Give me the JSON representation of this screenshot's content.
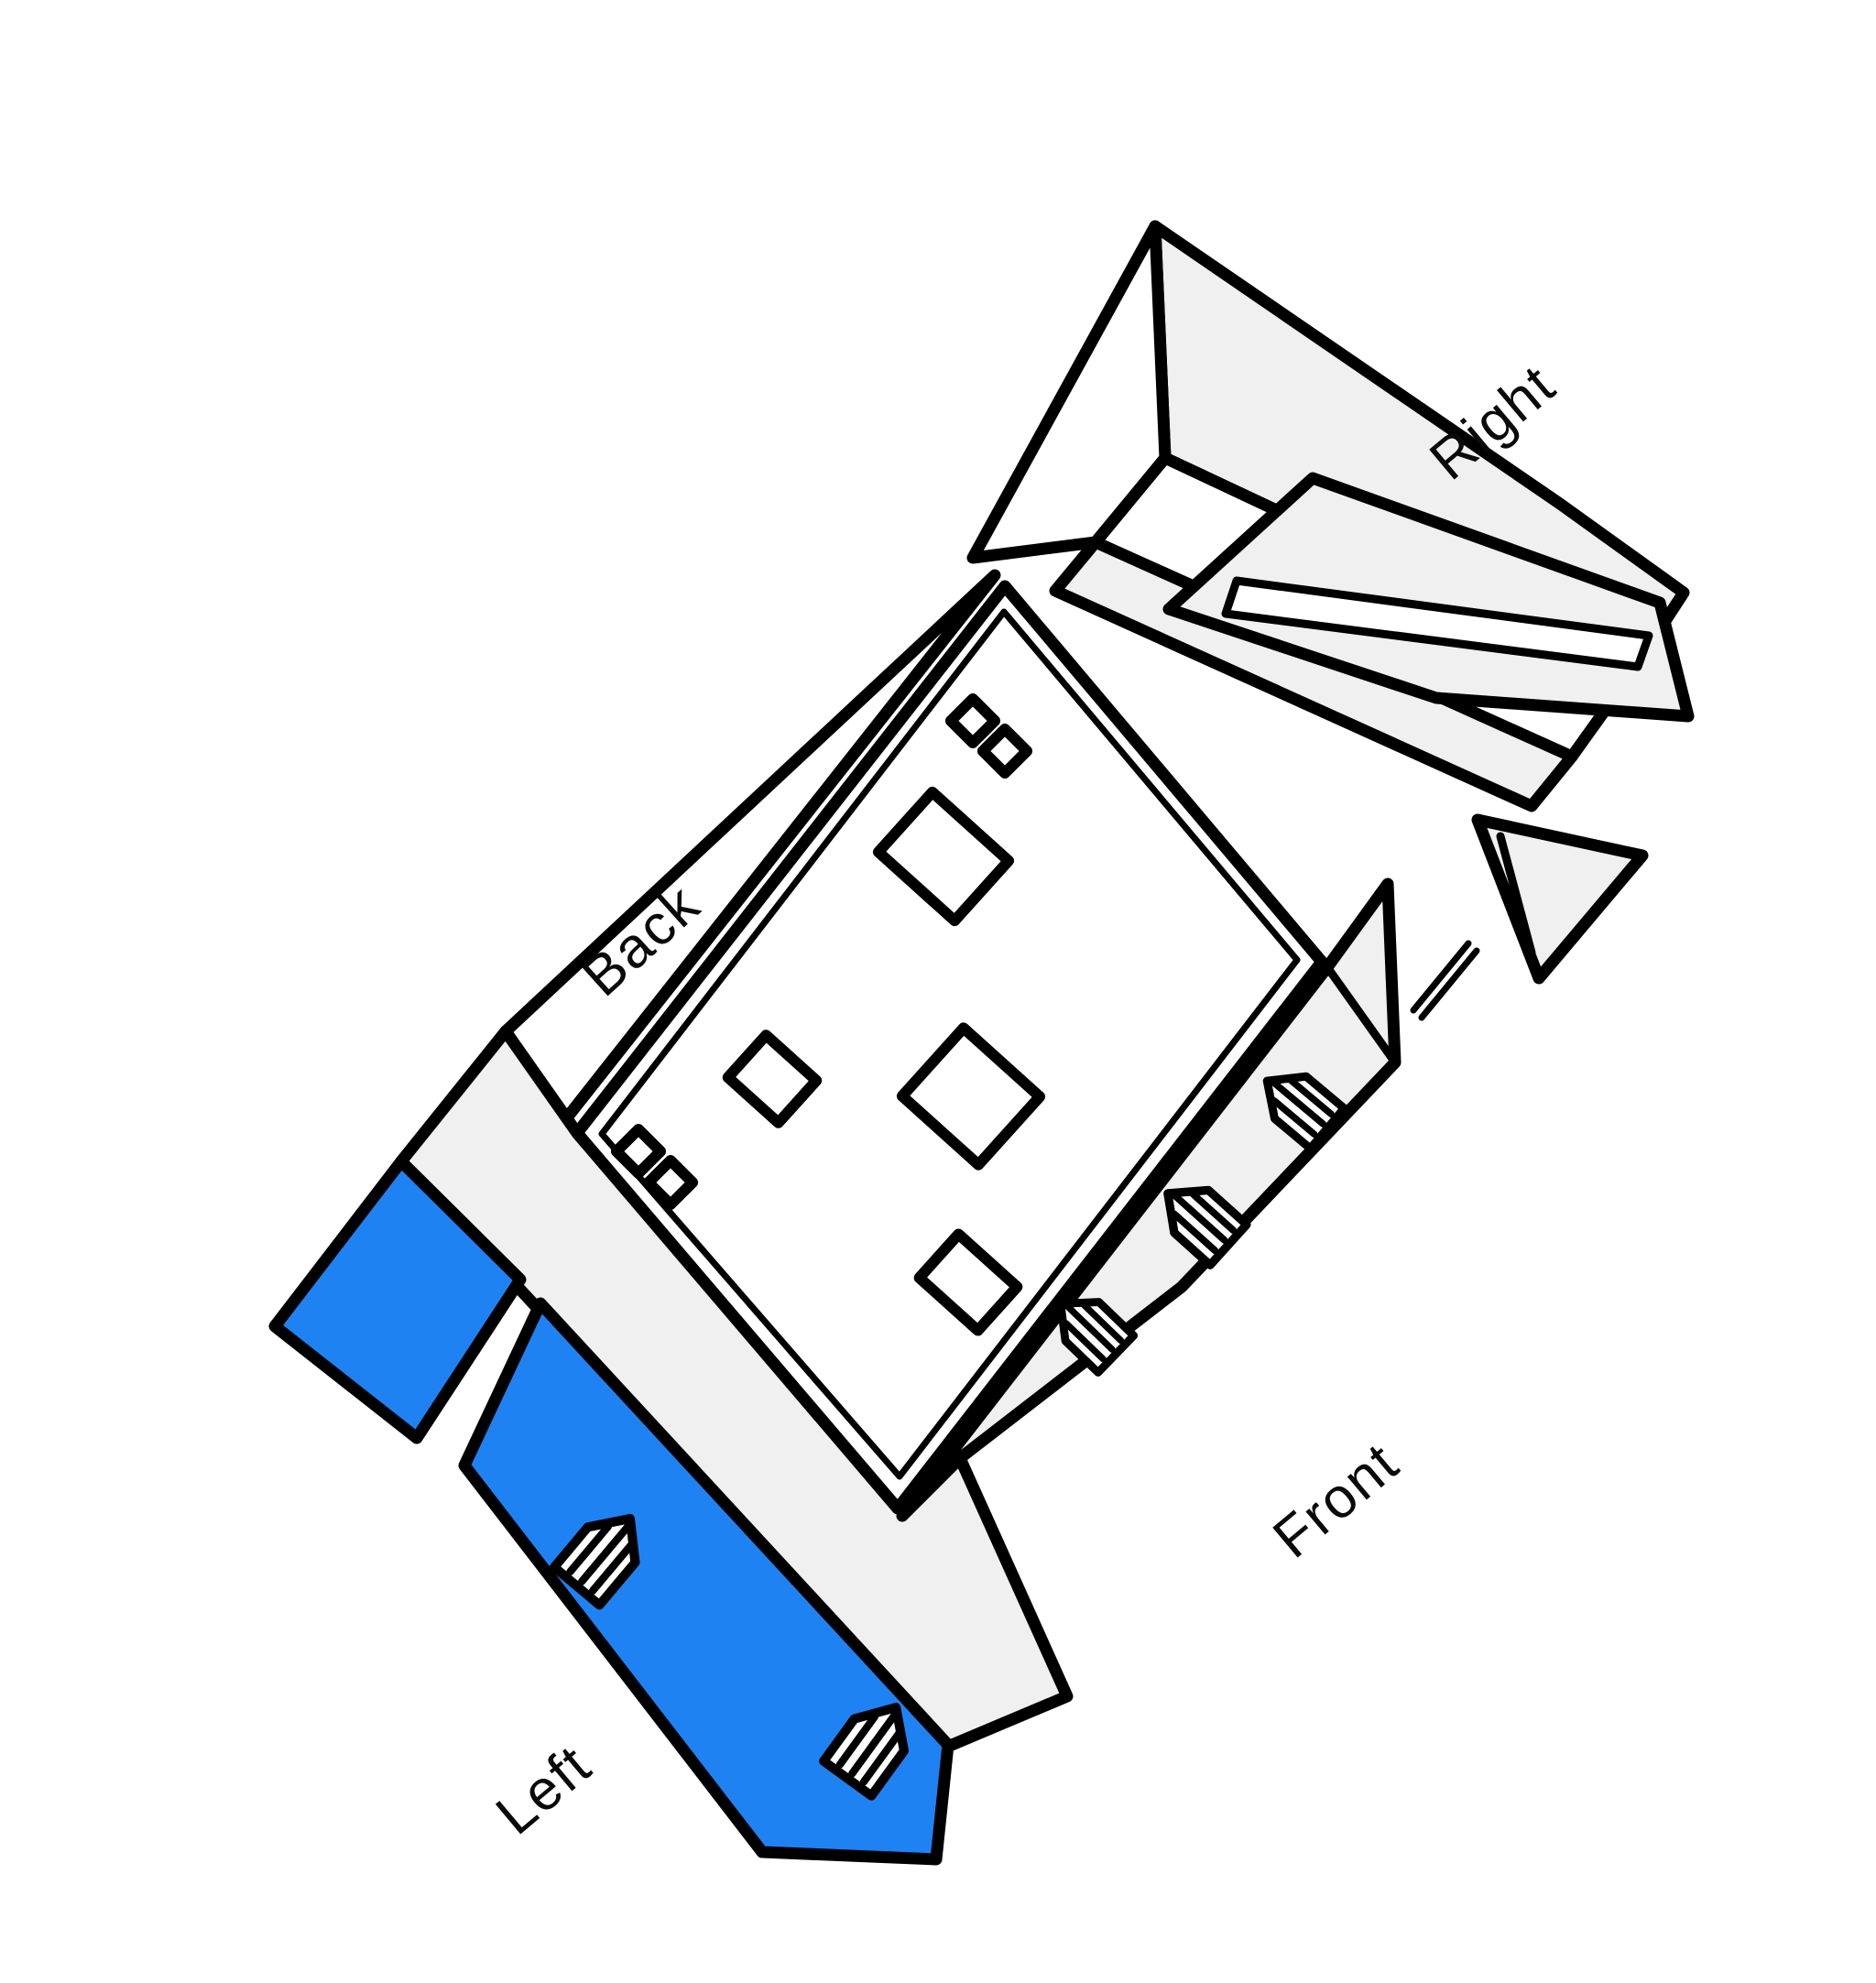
{
  "scene": {
    "kind": "unfolded-room-3d-sketch",
    "labels": {
      "right": "Right",
      "back": "Back",
      "front": "Front",
      "left": "Left"
    },
    "walls": [
      {
        "id": "right",
        "label": "Right",
        "fill": "#f0f0f0",
        "door_icons": 0,
        "highlighted": false
      },
      {
        "id": "back",
        "label": "Back",
        "fill": "#ffffff",
        "door_icons": 0,
        "highlighted": false
      },
      {
        "id": "front",
        "label": "Front",
        "fill": "#f0f0f0",
        "door_icons": 3,
        "highlighted": false
      },
      {
        "id": "left",
        "label": "Left",
        "fill": "#1f82f2",
        "door_icons": 2,
        "highlighted": true
      }
    ],
    "colors": {
      "highlight_blue": "#1f82f2",
      "wall_gray": "#f0f0f0",
      "line_black": "#000000",
      "background": "#ffffff"
    },
    "floor": {
      "furniture_rects": 4,
      "small_marker_pairs": 2
    }
  }
}
